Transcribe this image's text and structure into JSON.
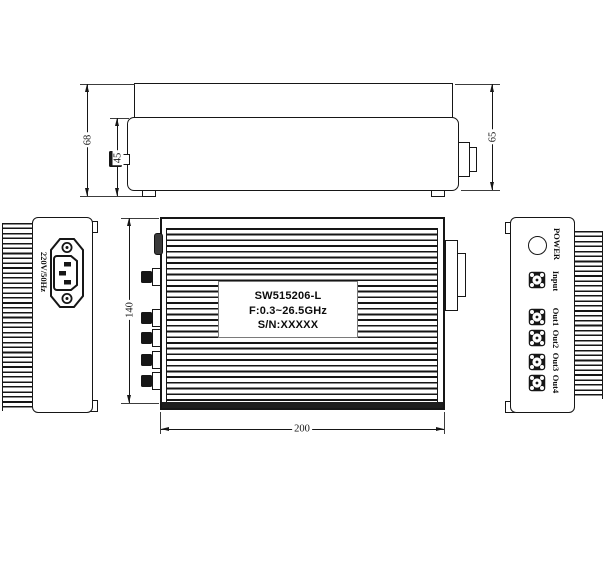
{
  "colors": {
    "line": "#161616",
    "background": "#ffffff"
  },
  "side_view": {
    "dim_total_height": "68",
    "dim_body_height": "45",
    "dim_right_height": "65"
  },
  "front_view": {
    "dim_height": "140",
    "dim_width": "200",
    "label_line1": "SW515206-L",
    "label_line2": "F:0.3~26.5GHz",
    "label_line3": "S/N:XXXXX"
  },
  "power_panel": {
    "voltage_rating": "220V/50Hz",
    "icon": "power-inlet-icon"
  },
  "connector_panel": {
    "power_label": "POWER",
    "input_label": "Input",
    "output_labels": [
      "Out1",
      "Out2",
      "Out3",
      "Out4"
    ],
    "icons": [
      "power-indicator-icon",
      "rf-connector-icon"
    ]
  }
}
